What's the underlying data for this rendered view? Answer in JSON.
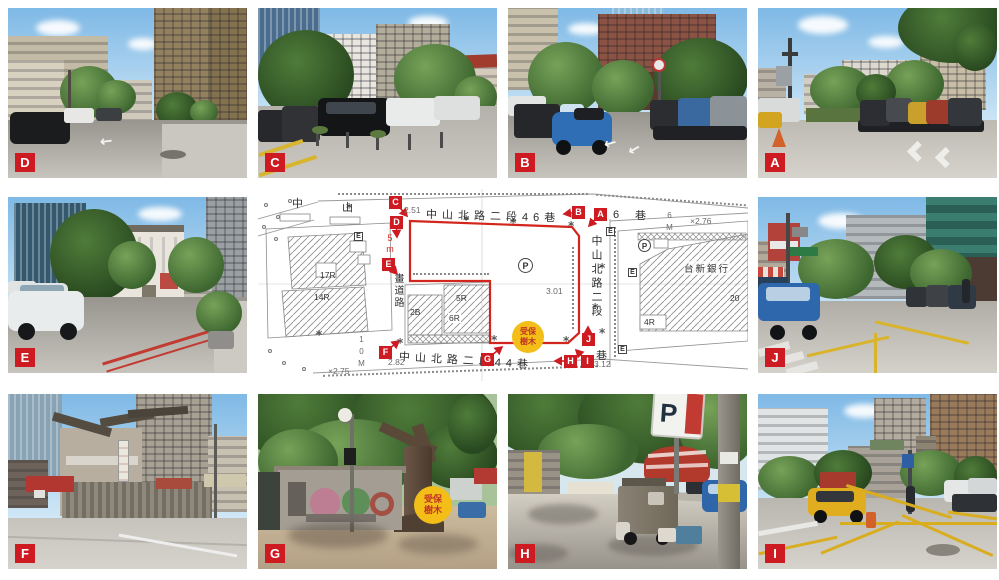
{
  "figure": {
    "type": "site-survey-photo-map",
    "background": "#ffffff",
    "accent_red": "#ce1b22",
    "map_boundary_red": "#d2251c",
    "tree_badge_yellow": "#f2be17"
  },
  "symbols": {
    "survey_star": "*",
    "road_arrow_left": "←",
    "road_arrow_up": "↑"
  },
  "photos": {
    "a": {
      "label": "A"
    },
    "b": {
      "label": "B"
    },
    "c": {
      "label": "C"
    },
    "d": {
      "label": "D"
    },
    "e": {
      "label": "E"
    },
    "f": {
      "label": "F"
    },
    "g": {
      "label": "G"
    },
    "h": {
      "label": "H",
      "sign": "P"
    },
    "i": {
      "label": "I"
    },
    "j": {
      "label": "J"
    }
  },
  "map": {
    "streets": {
      "top": "中山北路二段46巷",
      "bottom": "中山北路二段44巷",
      "right_vertical": "中山北路二段",
      "right_lane_suffix": "巷",
      "top_right_number": "6",
      "top_right_lane": "巷",
      "top_left_char_1": "中",
      "top_left_char_2": "山",
      "planned_road": "畫道路"
    },
    "tree_badge": {
      "line1": "受保",
      "line2": "樹木"
    },
    "bank_label": "台新銀行",
    "parking_symbol": "P",
    "utility_box": "E",
    "building_labels": {
      "left_17r": "17R",
      "left_14r": "14R",
      "mid_2b": "2B",
      "mid_5r": "5R",
      "mid_6r": "6R",
      "right_4r": "4R",
      "right_20": "20"
    },
    "elevations": {
      "c_corner": "2.51",
      "center": "3.01",
      "f_corner": "2.82",
      "southwest": "×2.75",
      "i_corner": "3.12",
      "northeast": "×2.76"
    },
    "dimensions": {
      "west_width": "5m",
      "south_width": "10M",
      "east_width": "6M"
    },
    "markers": [
      {
        "id": "A"
      },
      {
        "id": "B"
      },
      {
        "id": "C"
      },
      {
        "id": "D"
      },
      {
        "id": "E"
      },
      {
        "id": "F"
      },
      {
        "id": "G"
      },
      {
        "id": "H"
      },
      {
        "id": "I"
      },
      {
        "id": "J"
      }
    ]
  }
}
